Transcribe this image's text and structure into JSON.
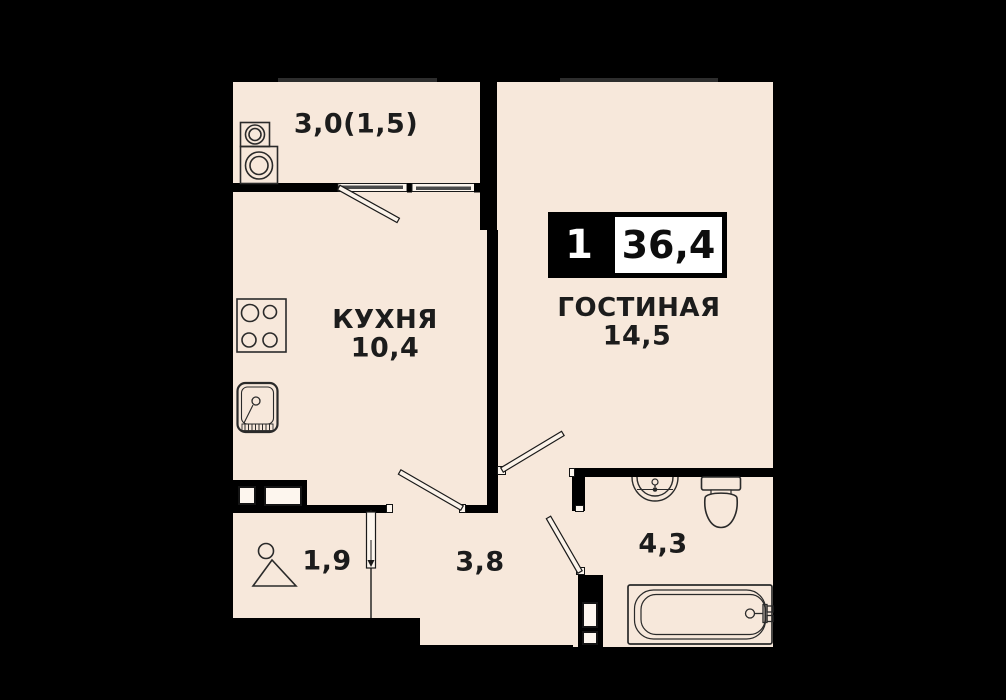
{
  "plan": {
    "badge": {
      "room_count": "1",
      "total_area": "36,4"
    },
    "rooms": {
      "balcony": {
        "area": "3,0(1,5)"
      },
      "kitchen": {
        "label": "КУХНЯ",
        "area": "10,4"
      },
      "living": {
        "label": "ГОСТИНАЯ",
        "area": "14,5"
      },
      "wardrobe": {
        "area": "1,9"
      },
      "hallway": {
        "area": "3,8"
      },
      "bathroom": {
        "area": "4,3"
      }
    },
    "icons": {
      "washer_stack": "stacked washer and dryer",
      "stove": "4-burner stove",
      "kitchen_sink": "kitchen sink",
      "hanger": "clothes hanger",
      "wash_basin": "wash basin",
      "toilet": "toilet",
      "bathtub": "bathtub",
      "vent_shaft": "ventilation shaft",
      "wardrobe_cabinet": "built-in cabinet"
    },
    "colors": {
      "background": "#000000",
      "floor": "#f7e8db",
      "wall": "#000000",
      "text": "#1c1c1c",
      "badge_bg": "#000000",
      "badge_text": "#ffffff",
      "badge_area_bg": "#ffffff"
    }
  }
}
